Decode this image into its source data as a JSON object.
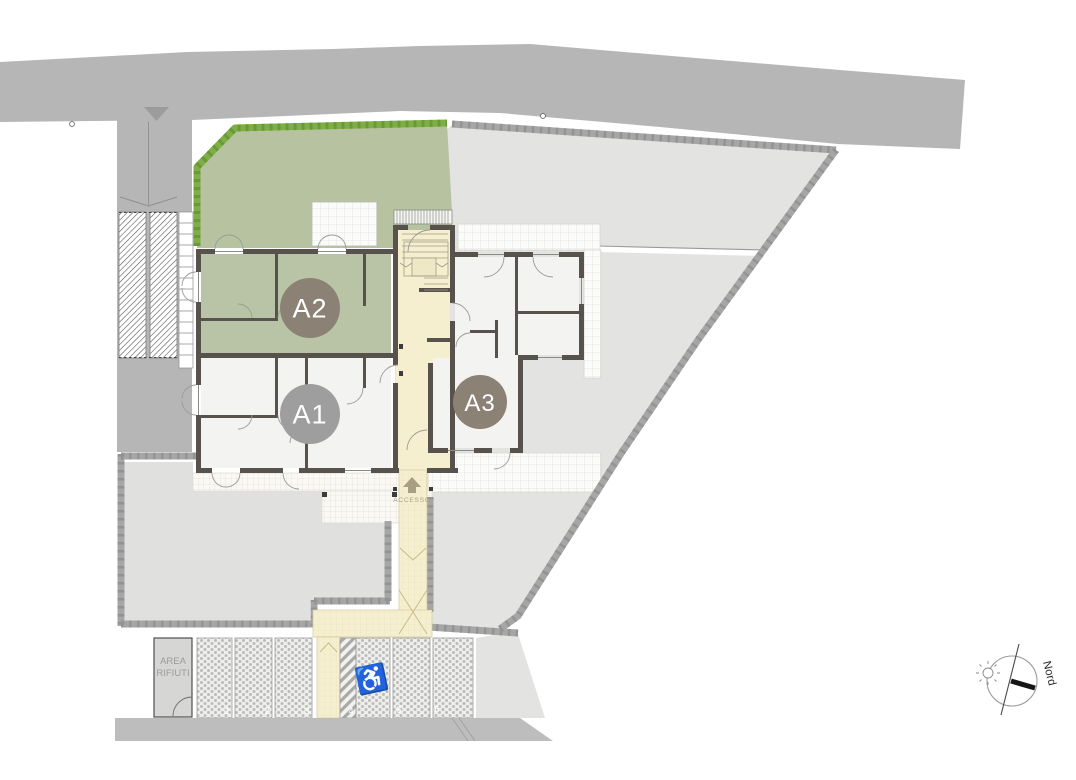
{
  "units": [
    {
      "label": "A1",
      "badge_color": "#9e9e9e"
    },
    {
      "label": "A2",
      "badge_color": "#8b8174"
    },
    {
      "label": "A3",
      "badge_color": "#8b8174"
    }
  ],
  "access_label": "ACCESSO",
  "waste_area": {
    "line1": "AREA",
    "line2": "RIFIUTI"
  },
  "compass": {
    "north_label": "Nord"
  },
  "parking": {
    "spaces": [
      "1",
      "2",
      "3",
      "4",
      "5",
      "6"
    ]
  },
  "palette": {
    "road": "#b6b6b6",
    "yard": "#e3e3e2",
    "garden": "#b7c3a0",
    "a2_floor": "#b9c4a6",
    "stair_cream": "#f6efcf",
    "walls": "#57524b",
    "hedge": "#79a944",
    "stone_wall": "#a6a6a6",
    "accesso_olive": "#a89f7e"
  }
}
